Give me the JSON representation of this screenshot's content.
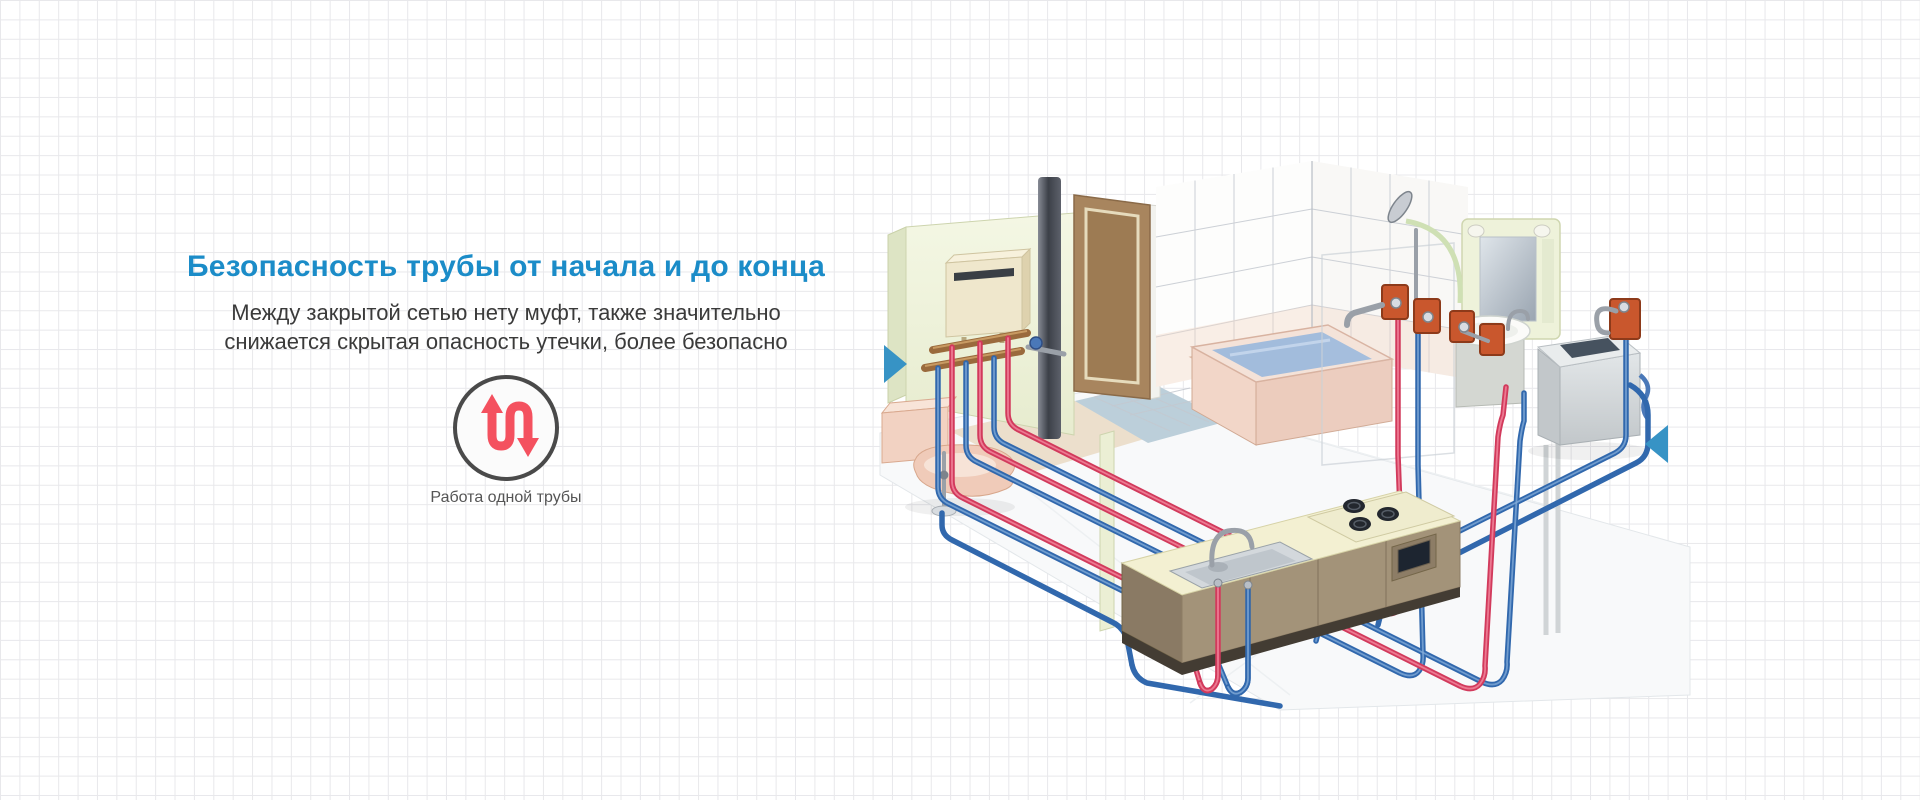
{
  "section": {
    "heading": "Безопасность трубы от начала и до конца",
    "subtitle_line1": "Между закрытой сетью нету муфт, также значительно",
    "subtitle_line2": "снижается скрытая опасность утечки, более безопасно",
    "feature": {
      "caption": "Работа одной трубы",
      "icon": "single-pipe-s-flow-arrows-icon"
    }
  },
  "carousel": {
    "prev_icon": "triangle-right-icon",
    "next_icon": "triangle-left-icon"
  },
  "colors": {
    "heading_blue": "#1b8cc8",
    "body_text": "#3a3a3a",
    "caption_text": "#555555",
    "icon_red": "#f4515f",
    "icon_circle_ring": "#4a4a4a",
    "arrow_blue": "#3793c5",
    "pipe_hot_red": "#d23a5c",
    "pipe_cold_blue": "#3168ad",
    "grid_line": "#e8e8eb",
    "fixture_orange": "#c9572d"
  },
  "illustration": {
    "name": "home-plumbing-isometric-cutaway",
    "objects": [
      "water heater",
      "copper supply manifold",
      "drain stack pipe",
      "door",
      "tiled bathroom walls",
      "bathtub with water",
      "shower set with wall outlets",
      "mirror cabinet",
      "washbasin on pedestal",
      "washing machine with tap",
      "toilet",
      "kitchen counter with sink, gas stove and oven",
      "hot water pipes",
      "cold water pipes"
    ]
  }
}
